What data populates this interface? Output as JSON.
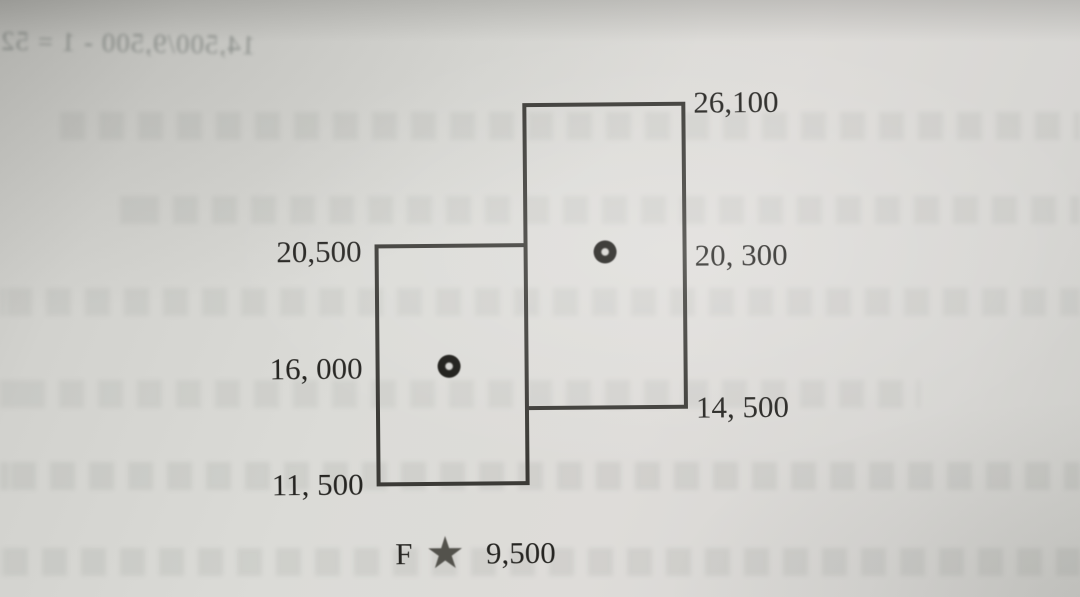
{
  "figure": {
    "description": "Two overlapping salary-range boxes with midpoint dots, printed in a textbook",
    "boxes": [
      {
        "name": "left-range",
        "max_label": "20,500",
        "mid_label": "16, 000",
        "min_label": "11, 500"
      },
      {
        "name": "right-range",
        "max_label": "26,100",
        "mid_label": "20, 300",
        "min_label": "14, 500"
      }
    ],
    "caption": {
      "prefix": "F",
      "star_icon": "★",
      "value": "9,500"
    }
  },
  "chart_data": {
    "type": "range-boxes",
    "series": [
      {
        "name": "left box",
        "min": 11500,
        "midpoint": 16000,
        "max": 20500
      },
      {
        "name": "right box",
        "min": 14500,
        "midpoint": 20300,
        "max": 26100
      }
    ],
    "annotation": "F ★ 9,500",
    "notes": "midpoints drawn as bullseye dots inside each box; boxes share a vertical edge"
  },
  "bleedthrough": {
    "formula_line": "14,500/9,500 - 1 = 52",
    "appearance": "mirrored faint text showing through from reverse side of page"
  },
  "colors": {
    "paper": "#d8d7d3",
    "line": "#3b3a36",
    "text": "#262522",
    "star": "#53524c"
  }
}
